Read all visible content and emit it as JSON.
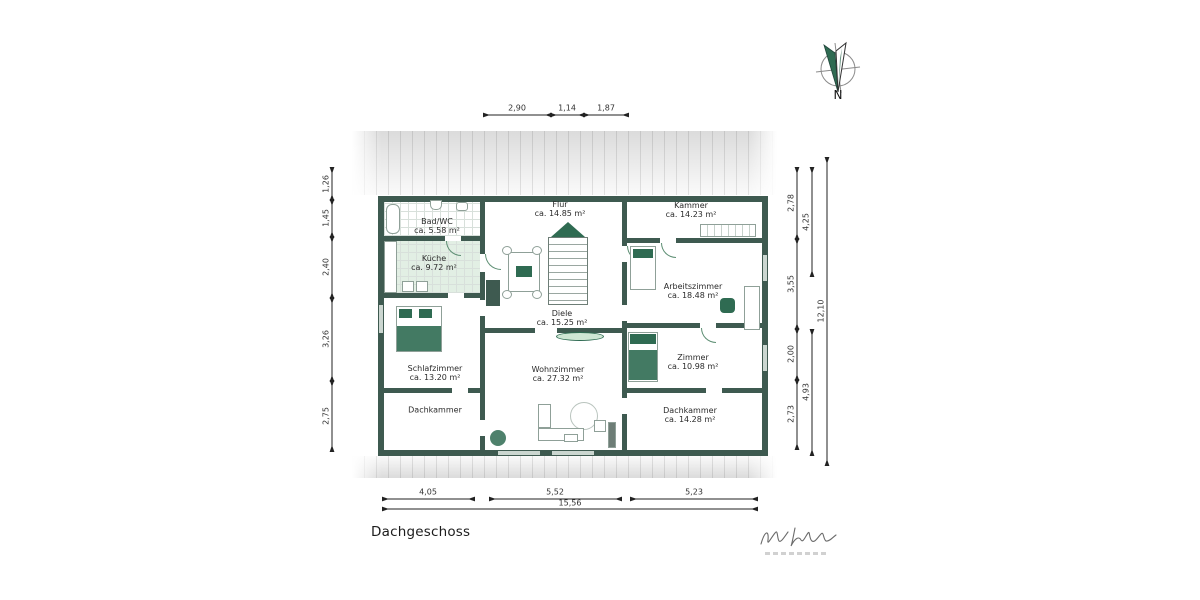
{
  "title": "Dachgeschoss",
  "compass": {
    "label": "N"
  },
  "rooms": {
    "badwc": {
      "name": "Bad/WC",
      "area": "ca. 5.58 m²"
    },
    "kueche": {
      "name": "Küche",
      "area": "ca. 9.72 m²"
    },
    "flur": {
      "name": "Flur",
      "area": "ca. 14.85 m²"
    },
    "kammer": {
      "name": "Kammer",
      "area": "ca. 14.23 m²"
    },
    "arbeitszimmer": {
      "name": "Arbeitszimmer",
      "area": "ca. 18.48 m²"
    },
    "diele": {
      "name": "Diele",
      "area": "ca. 15.25 m²"
    },
    "zimmer": {
      "name": "Zimmer",
      "area": "ca. 10.98 m²"
    },
    "schlafzimmer": {
      "name": "Schlafzimmer",
      "area": "ca. 13.20 m²"
    },
    "wohnzimmer": {
      "name": "Wohnzimmer",
      "area": "ca. 27.32 m²"
    },
    "dachkammer_l": {
      "name": "Dachkammer"
    },
    "dachkammer_r": {
      "name": "Dachkammer",
      "area": "ca. 14.28 m²"
    }
  },
  "dims": {
    "top": [
      "2,90",
      "1,14",
      "1,87"
    ],
    "bottom": [
      "4,05",
      "5,52",
      "5,23"
    ],
    "bottom_total": "15,56",
    "left": [
      "1,26",
      "1,45",
      "2,40",
      "3,26",
      "2,75"
    ],
    "right_inner": [
      "2,78",
      "3,55",
      "2,00",
      "2,73"
    ],
    "right_middle": [
      "4,25",
      "4,93"
    ],
    "right_total": "12,10"
  },
  "colors": {
    "wall": "#3E5A50",
    "furniture_green": "#2F6B52",
    "kitchen_tint": "#E2EFE4"
  }
}
